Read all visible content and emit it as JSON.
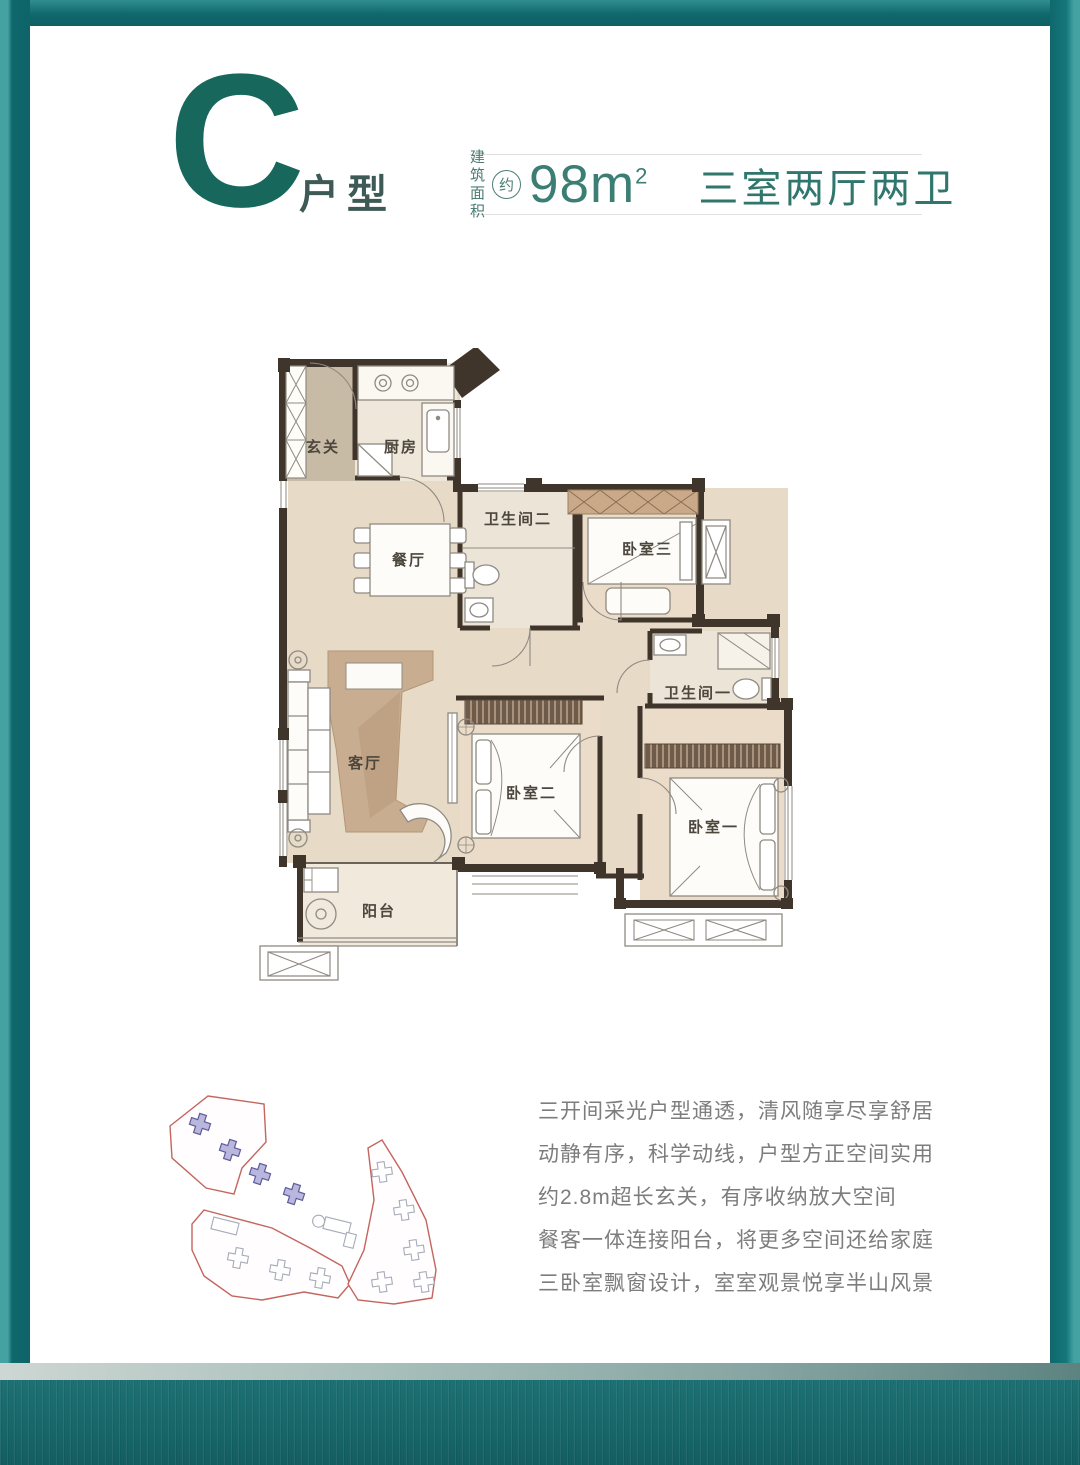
{
  "header": {
    "type_letter": "C",
    "type_label": "户型",
    "area_label_top": "建筑",
    "area_label_bottom": "面积",
    "area_approx": "约",
    "area_value": "98m",
    "area_sup": "2",
    "layout_label": "三室两厅两卫"
  },
  "floorplan": {
    "rooms": {
      "entry": "玄关",
      "kitchen": "厨房",
      "dining": "餐厅",
      "bath2": "卫生间二",
      "bed3": "卧室三",
      "bath1": "卫生间一",
      "living": "客厅",
      "bed2": "卧室二",
      "bed1": "卧室一",
      "balcony": "阳台"
    }
  },
  "description": {
    "lines": [
      "三开间采光户型通透，清风随享尽享舒居",
      "动静有序，科学动线，户型方正空间实用",
      "约2.8m超长玄关，有序收纳放大空间",
      "餐客一体连接阳台，将更多空间还给家庭",
      "三卧室飘窗设计，室室观景悦享半山风景"
    ]
  },
  "colors": {
    "brand_teal": "#17675c",
    "frame_teal": "#0f686c",
    "wall_dark": "#3f352b",
    "floor_main": "#e7dac6",
    "site_outline_red": "#c4655e",
    "site_building_blue": "#8d8ac0"
  }
}
